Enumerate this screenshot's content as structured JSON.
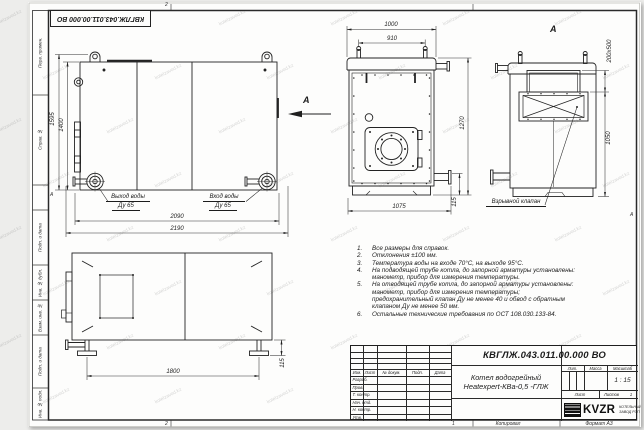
{
  "watermark": "kotelzavod.kz",
  "frame": {
    "left_labels": [
      "Перв. примен.",
      "Справ. №",
      "Подп. и дата",
      "Инв. № дубл.",
      "Взам. инв. №",
      "Подп. и дата",
      "Инв. № подл."
    ],
    "zone_top": "2",
    "zone_bottom_left": "2",
    "zone_bottom_center": "1",
    "zone_side_left": "А",
    "zone_side_right": "А",
    "copied": "Копировал",
    "format": "Формат А3"
  },
  "views": {
    "side": {
      "dim_total_h": "1595",
      "dim_inner_h": "1400",
      "dim_w1": "2090",
      "dim_w2": "2190",
      "outlet_line1": "Выход воды",
      "outlet_line2": "Ду 65",
      "inlet_line1": "Вход воды",
      "inlet_line2": "Ду 65",
      "arrow_label": "А"
    },
    "front": {
      "dim_w1": "1000",
      "dim_w2": "910",
      "dim_h": "1270",
      "dim_base": "1075",
      "dim_foot": "115"
    },
    "rear": {
      "view_label": "А",
      "dim_valve": "200х500",
      "dim_h": "1050",
      "valve_label": "Взрывной клапан"
    },
    "plan": {
      "dim_w": "1800",
      "dim_foot": "115"
    }
  },
  "notes": [
    {
      "num": "1.",
      "text": "Все размеры для справок."
    },
    {
      "num": "2.",
      "text": "Отклонения ±100 мм."
    },
    {
      "num": "3.",
      "text": "Температура воды на входе 70°С, на выходе 95°С."
    },
    {
      "num": "4.",
      "text": "На подводящей трубе котла, до запорной арматуры установлены: манометр, прибор для измерения температуры."
    },
    {
      "num": "5.",
      "text": "На отводящей трубе котла, до запорной арматуры установлены: манометр, прибор для измерения температуры; предохранительный клапан Ду не менее 40 и обвод с обратным клапаном Ду не менее 50 мм."
    },
    {
      "num": "6.",
      "text": "Остальные технические требования по ОСТ 108.030.133-84."
    }
  ],
  "title_block": {
    "doc_number": "КВГЛЖ.043.011.00.000 ВО",
    "title_line1": "Котел водогрейный",
    "title_line2": "Heatexpert-КВа-0,5 -ГЛЖ",
    "header_cols": [
      "Изм.",
      "Лист",
      "№ докум.",
      "Подп.",
      "Дата"
    ],
    "rows": [
      "Разраб.",
      "Пров.",
      "Т. контр.",
      "Нач. отд.",
      "Н. контр.",
      "Утв."
    ],
    "lit_label": "Лит.",
    "mass_label": "Масса",
    "scale_label": "Масштаб",
    "scale_value": "1 : 15",
    "sheet_label": "Лист",
    "sheets_label": "Листов",
    "sheets_value": "1",
    "logo_text": "KVZR",
    "company_line1": "КОТЕЛЬНЫЙ",
    "company_line2": "ЗАВОД РЭП"
  }
}
